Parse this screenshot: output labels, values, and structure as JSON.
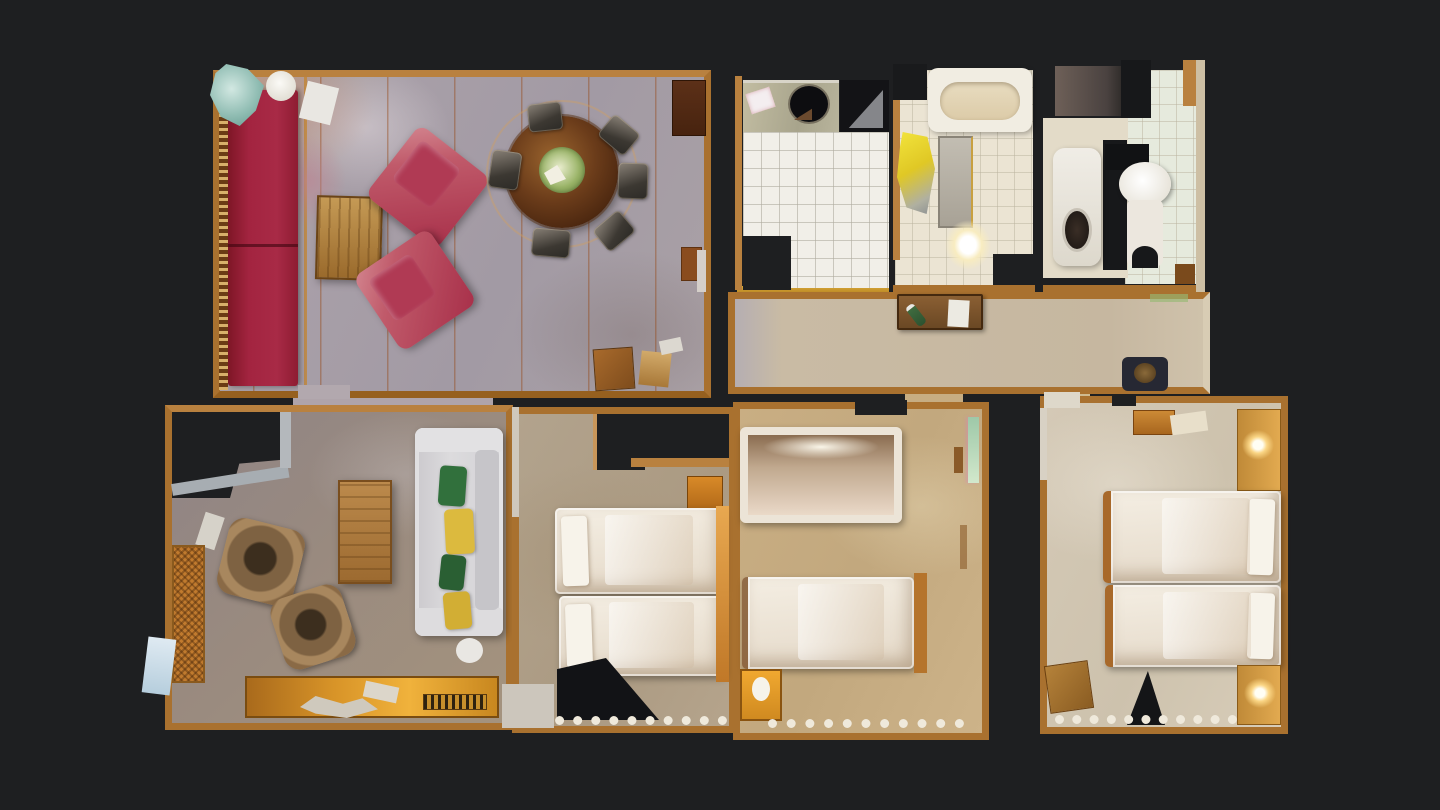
{
  "app": {
    "name": "apartment-3d-scan-floorplan",
    "description": "Top-down dollhouse floor plan view of a 3D-scanned apartment on a dark background"
  },
  "canvas": {
    "width": 1440,
    "height": 810,
    "background": "#1e1f21"
  },
  "palette": {
    "background": "#1e1f21",
    "wall_tan": "#a9712f",
    "wall_light": "#b9813f",
    "living_carpet_gray": "#a89fa8",
    "hall_carpet": "#c9bba4",
    "sitting_carpet": "#998a7f",
    "bedroom1_carpet": "#b2a38d",
    "bedroom2_carpet": "#c7ad82",
    "bedroom3_carpet": "#d2c7b3",
    "kitchen_tile": "#f1efe8",
    "bath_tile": "#ebe4d3",
    "sofa_red": "#a32440",
    "armchair_red": "#b84a5c",
    "sofa_white": "#d9d8da",
    "wood_light": "#c59a55",
    "wood_dark": "#6b3c1a",
    "bed_white": "#efe8dc",
    "towel_yellow": "#e8d52a",
    "pillow_green": "#2f6b38",
    "pillow_yellow": "#dcba3e",
    "lamp_glow": "#fff7d9",
    "scan_artifact_orange": "#94420c"
  },
  "rooms": [
    {
      "id": "living-dining-room",
      "label": "Living and dining room",
      "furniture": [
        "red-sofa",
        "red-armchair-1",
        "red-armchair-2",
        "wood-coffee-table",
        "round-dining-table",
        "dining-chairs-x6",
        "tall-cabinet",
        "side-cabinet",
        "writing-desk",
        "floor-plant",
        "white-vase"
      ]
    },
    {
      "id": "kitchen",
      "label": "Kitchen",
      "furniture": [
        "counter",
        "round-sink",
        "stove",
        "white-tile-floor",
        "towel"
      ]
    },
    {
      "id": "bathroom",
      "label": "Bathroom",
      "furniture": [
        "bathtub",
        "yellow-towel",
        "washing-machine",
        "glowing-fixture"
      ]
    },
    {
      "id": "wc",
      "label": "WC",
      "furniture": [
        "pedestal-basin",
        "toilet",
        "cistern",
        "dark-panel"
      ]
    },
    {
      "id": "hallway",
      "label": "Hallway",
      "furniture": [
        "wooden-chest",
        "paper-sheet",
        "green-bottle",
        "dark-bag"
      ]
    },
    {
      "id": "sitting-room",
      "label": "Sitting room",
      "furniture": [
        "white-sofa",
        "green-yellow-pillows",
        "wood-coffee-table",
        "rattan-chair-1",
        "rattan-chair-2",
        "radiator",
        "orange-sideboard-vent"
      ]
    },
    {
      "id": "bedroom-1",
      "label": "Bedroom 1",
      "furniture": [
        "twin-bed-1",
        "twin-bed-2",
        "orange-cabinet"
      ]
    },
    {
      "id": "bedroom-2",
      "label": "Bedroom 2",
      "furniture": [
        "framed-bed",
        "single-bed",
        "orange-nightstand",
        "green-door"
      ]
    },
    {
      "id": "bedroom-3",
      "label": "Bedroom 3",
      "furniture": [
        "twin-bed-1",
        "twin-bed-2",
        "headboard-lamp-top",
        "headboard-lamp-bottom",
        "stool",
        "wooden-chair"
      ]
    }
  ]
}
